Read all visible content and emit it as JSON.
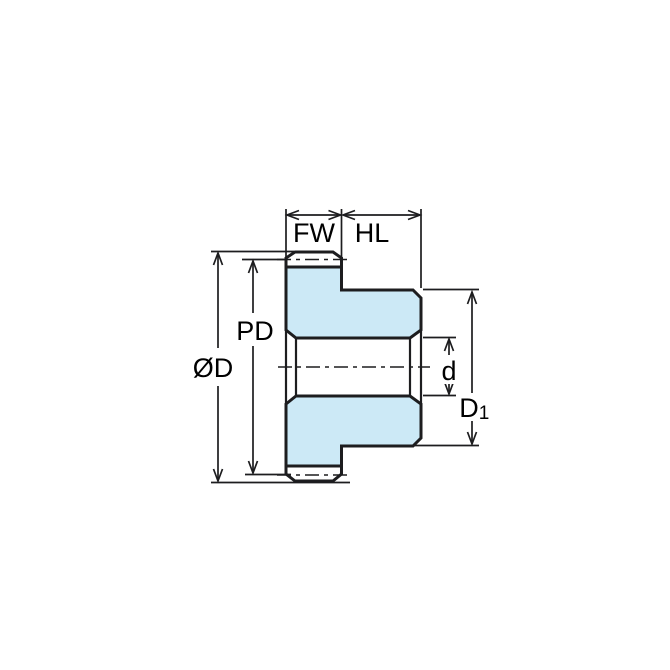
{
  "diagram": {
    "kind": "technical-dimension-drawing",
    "subject": "spur gear with hub, side cross-section view",
    "colors": {
      "background": "#ffffff",
      "body_fill": "#cce9f6",
      "outline": "#1d1d1f",
      "dimension": "#1d1d1f"
    },
    "labels": {
      "face_width": "FW",
      "hub_length": "HL",
      "outside_diameter": "ØD",
      "pitch_diameter": "PD",
      "bore_diameter": "d",
      "hub_diameter_base": "D",
      "hub_diameter_subscript": "1"
    }
  }
}
